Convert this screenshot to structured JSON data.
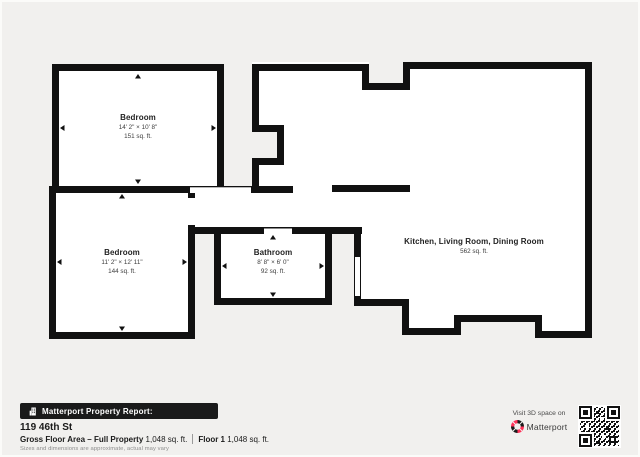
{
  "colors": {
    "page_bg": "#f1f0ee",
    "wall": "#111111",
    "room_fill": "#ffffff",
    "badge_bg": "#1a1a1a",
    "brand_red": "#ff3158",
    "muted_text": "#8d8d8d"
  },
  "rooms": [
    {
      "name": "Bedroom",
      "dims": "14' 2\" × 10' 8\"",
      "area": "151 sq. ft."
    },
    {
      "name": "Bedroom",
      "dims": "11' 2\" × 12' 11\"",
      "area": "144 sq. ft."
    },
    {
      "name": "Bathroom",
      "dims": "8' 8\" × 6' 0\"",
      "area": "92 sq. ft."
    },
    {
      "name": "Kitchen, Living Room, Dining Room",
      "dims": "",
      "area": "562 sq. ft."
    }
  ],
  "footer": {
    "report_badge": "Matterport Property Report:",
    "badge_icon": "building-icon",
    "address": "119 46th St",
    "gross_label": "Gross Floor Area – Full Property",
    "gross_value": " 1,048 sq. ft.",
    "floor_label": "Floor 1",
    "floor_value": " 1,048 sq. ft.",
    "disclaimer": "Sizes and dimensions are approximate, actual may vary",
    "visit_text": "Visit 3D space on",
    "brand": "Matterport",
    "brand_icon": "matterport-logo-icon",
    "qr": "qr-code"
  }
}
